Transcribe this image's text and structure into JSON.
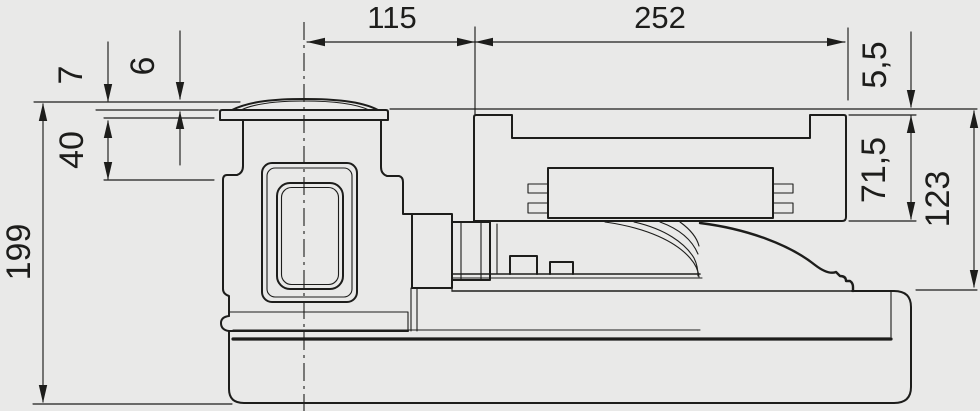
{
  "drawing": {
    "type": "dimensioned side-view technical drawing of a pump/skimmer unit",
    "units_implied": "mm",
    "colors": {
      "background": "#e9e9e8",
      "line": "#1d1d1b"
    },
    "dimensions": {
      "lid_center_to_canister": "115",
      "canister_width": "252",
      "lid_collar_height": "7",
      "lid_dome_height": "6",
      "lid_inset_depth": "40",
      "overall_height": "199",
      "canister_lid_recess": "5,5",
      "canister_lid_height": "71,5",
      "canister_body_height": "123"
    }
  }
}
